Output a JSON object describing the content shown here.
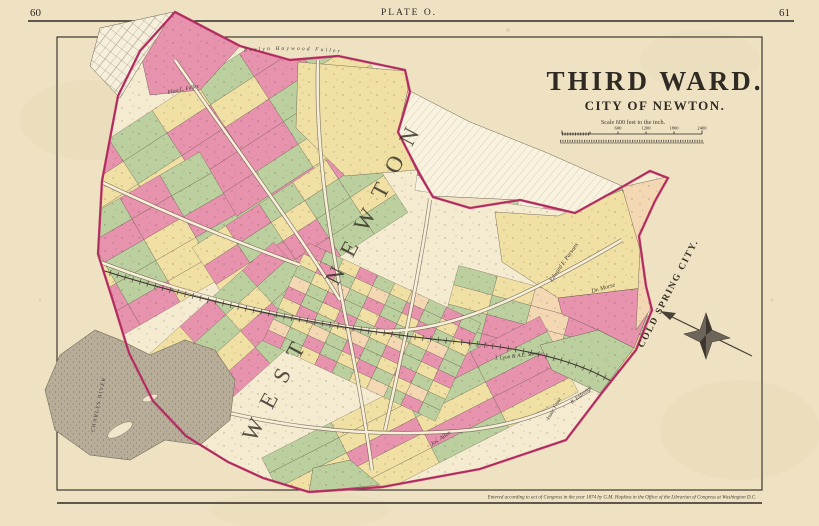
{
  "page": {
    "left_page_number": "60",
    "right_page_number": "61",
    "plate_label": "PLATE O."
  },
  "title_block": {
    "title": "THIRD WARD.",
    "subtitle": "CITY OF NEWTON.",
    "scale_text": "Scale 600 feet to the inch.",
    "scale_ticks": [
      "600",
      "1200",
      "1800",
      "2400"
    ]
  },
  "map": {
    "large_labels": {
      "district": "WEST NEWTON",
      "neighbor_city": "COLD SPRING CITY."
    },
    "water_label": "CHARLES RIVER",
    "parcel_labels": [
      "Evelyn Haywood Fuller",
      "Eliza L. Fuller",
      "Edward F. Parsons",
      "Dr. Morse",
      "J. Lyon & A.E. Snow",
      "R. Eldredge",
      "Isaac Frost",
      "Jos. Allen"
    ]
  },
  "footer": {
    "copyright": "Entered according to act of Congress in the year 1874 by G.M. Hopkins in the Office of the Librarian of Congress at Washington D.C."
  }
}
